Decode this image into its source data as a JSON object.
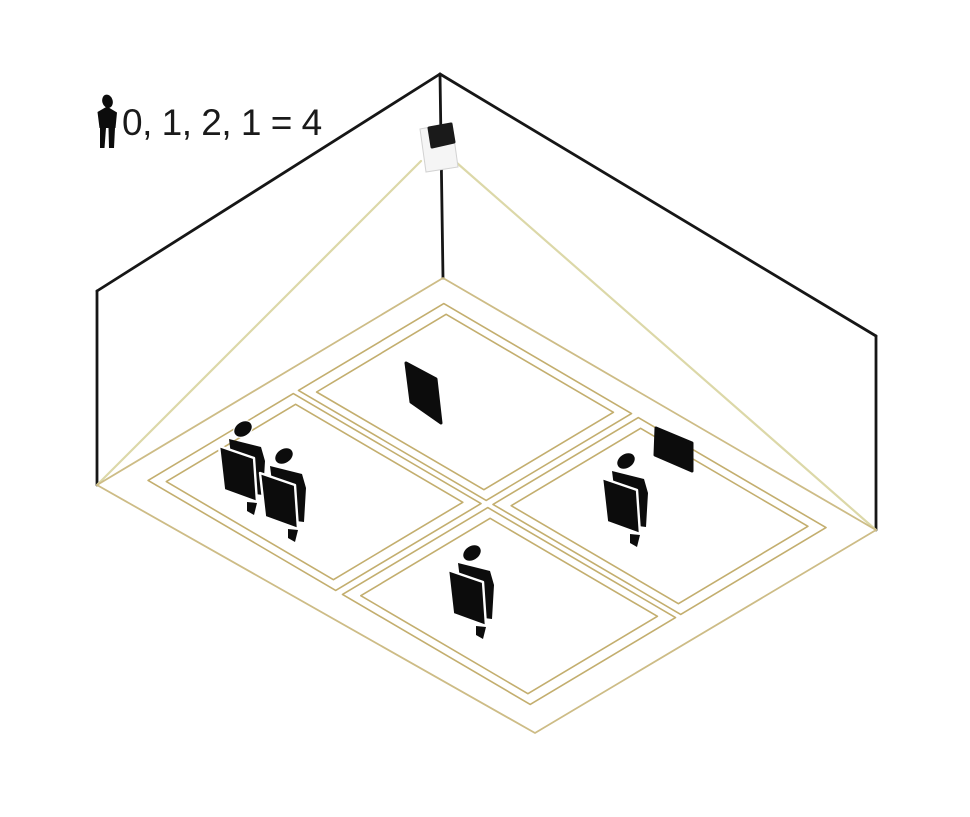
{
  "legend": {
    "icon": "person",
    "counts_text": "0, 1, 2, 1 = 4",
    "zone_counts": [
      0,
      1,
      2,
      1
    ],
    "total": 4
  },
  "scene": {
    "description": "Ceiling-corner people-counting sensor viewing a room; its field of view covers a floor split into four detection zones",
    "sensor": {
      "name": "people-counting-sensor"
    },
    "zones": [
      {
        "id": "far",
        "people": 0,
        "panels": 1
      },
      {
        "id": "right",
        "people": 1,
        "panels": 1
      },
      {
        "id": "near",
        "people": 1,
        "panels": 0
      },
      {
        "id": "left",
        "people": 2,
        "panels": 0
      }
    ],
    "people_total": 4
  },
  "colors": {
    "background": "#ffffff",
    "wall_line": "#161616",
    "fov_ray": "#dcd8a8",
    "footprint_line": "#cdbc86",
    "zone_line": "#c3ae6e",
    "figure": "#0c0c0c",
    "text": "#1a1a1a",
    "sensor_body": "#f5f5f5",
    "sensor_screen": "#1a1a1a"
  }
}
